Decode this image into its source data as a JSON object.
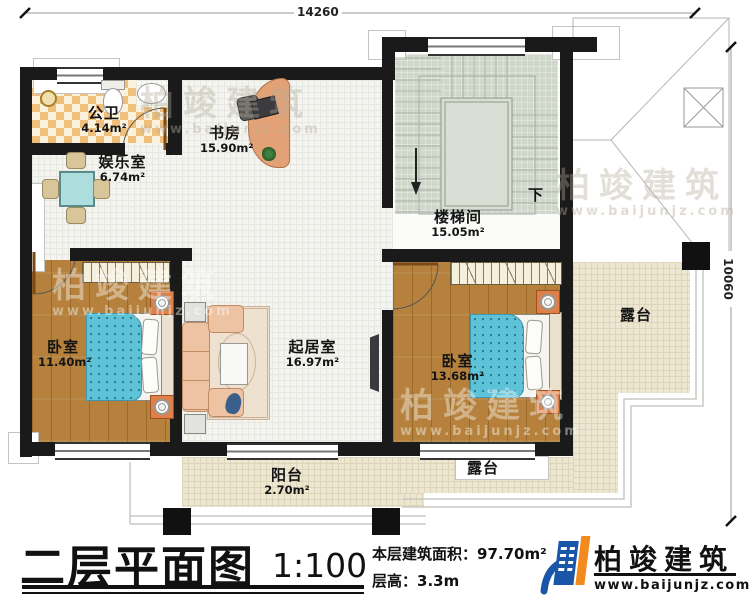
{
  "dimensions": {
    "top": "14260",
    "right": "10060"
  },
  "rooms": [
    {
      "id": "bathroom",
      "name": "公卫",
      "area": "4.14m²"
    },
    {
      "id": "entertainment",
      "name": "娱乐室",
      "area": "6.74m²"
    },
    {
      "id": "study",
      "name": "书房",
      "area": "15.90m²"
    },
    {
      "id": "stairwell",
      "name": "楼梯间",
      "area": "15.05m²"
    },
    {
      "id": "bedroom-left",
      "name": "卧室",
      "area": "11.40m²"
    },
    {
      "id": "living",
      "name": "起居室",
      "area": "16.97m²"
    },
    {
      "id": "bedroom-right",
      "name": "卧室",
      "area": "13.68m²"
    },
    {
      "id": "balcony",
      "name": "阳台",
      "area": "2.70m²"
    },
    {
      "id": "terrace-right",
      "name": "露台"
    },
    {
      "id": "terrace-bottom",
      "name": "露台"
    }
  ],
  "stair_direction_label": "下",
  "title_block": {
    "title": "二层平面图",
    "scale": "1:100",
    "area_label": "本层建筑面积：",
    "area_value": "97.70m²",
    "height_label": "层高：",
    "height_value": "3.3m"
  },
  "logo": {
    "name": "柏竣建筑",
    "website": "www.baijunjz.com",
    "blue": "#1a56a8",
    "orange": "#f28a1d"
  },
  "watermark": {
    "text": "柏竣建筑",
    "subtext": "www.baijunjz.com"
  }
}
